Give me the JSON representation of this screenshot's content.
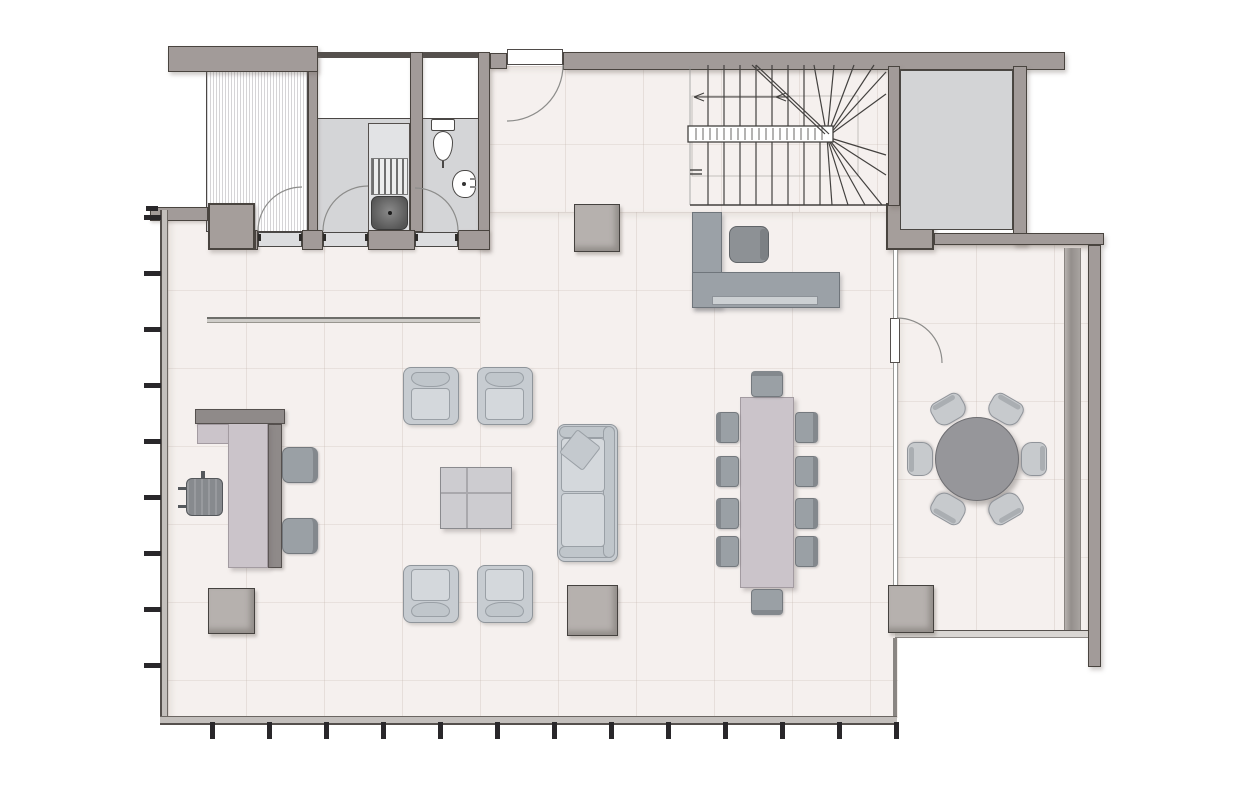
{
  "plan_type": "floor-plan",
  "palette": {
    "background": "#ffffff",
    "wall": "#a29b99",
    "wall_outline": "#49443f",
    "glass_wall": "#c3bfbc",
    "floor": "#f5f0ee",
    "room_gray": "#d4d5d7",
    "shaft_gray": "#d3d4d6",
    "upholstery": "#c7ccd1",
    "upholstery_outline": "#8f959b",
    "table_mauve": "#cbc4ca",
    "chair_gray": "#9aa0a5",
    "desk_gray": "#9ba1a7",
    "planter_gray": "#b6b1ae",
    "round_table_gray": "#96969a",
    "stair_line": "#43413f",
    "mullion_dark": "#29272a",
    "arc_line": "#8c8c8a"
  },
  "rooms": [
    "wardrobe-closet",
    "utility-room",
    "wc",
    "entry-hall",
    "stair",
    "shaft",
    "open-plan-lounge",
    "meeting-room"
  ],
  "inventory": {
    "armchairs": 4,
    "sofa": 1,
    "sofa_pillow": 1,
    "coffee_table": 1,
    "side_tables": 4,
    "dining_table": 1,
    "dining_chairs": 10,
    "round_table": 1,
    "meeting_chairs": 6,
    "office_desk": 1,
    "task_chair": 1,
    "guest_chairs": 2,
    "reception_desk": 1,
    "reception_chair": 1,
    "toilet": 1,
    "washbasin": 1,
    "boiler": 1,
    "drying_rack": 1,
    "swing_doors": 5
  },
  "left_mullions_y": [
    215,
    271,
    327,
    383,
    439,
    495,
    551,
    607,
    663
  ],
  "bottom_mullions_x": [
    210,
    267,
    324,
    381,
    438,
    495,
    552,
    609,
    666,
    723,
    780,
    837,
    894
  ],
  "stairs": {
    "direction": "u-turn-with-winders",
    "upper_treads_x": [
      20,
      36,
      52,
      68,
      84,
      100,
      116
    ],
    "lower_treads_x": [
      20,
      36,
      52,
      68,
      84,
      100,
      116,
      132
    ],
    "upper_fan_ends": [
      [
        126,
        1
      ],
      [
        146,
        1
      ],
      [
        166,
        1
      ],
      [
        186,
        1
      ],
      [
        198,
        8
      ],
      [
        198,
        30
      ]
    ],
    "lower_fan_ends": [
      [
        198,
        91
      ],
      [
        198,
        111
      ],
      [
        194,
        141
      ],
      [
        177,
        141
      ],
      [
        160,
        141
      ],
      [
        144,
        141
      ]
    ],
    "fan_center": [
      139,
      73
    ],
    "baluster_from": 8,
    "baluster_to": 136,
    "baluster_step": 7
  },
  "dining": {
    "side_chair_y": [
      412,
      456,
      498,
      536
    ],
    "left_col_x": 716,
    "right_col_x": 795,
    "end_chair_x": 751,
    "top_chair_y": 371,
    "bottom_chair_y": 589
  },
  "meeting_table": {
    "cx": 977,
    "cy": 459,
    "radius": 42,
    "chair_angles": [
      30,
      90,
      150,
      210,
      270,
      330
    ],
    "chair_offset": 57
  },
  "armchairs": [
    {
      "x": 403,
      "y": 367,
      "face": "down"
    },
    {
      "x": 477,
      "y": 367,
      "face": "down"
    },
    {
      "x": 403,
      "y": 565,
      "face": "up"
    },
    {
      "x": 477,
      "y": 565,
      "face": "up"
    }
  ],
  "door_arcs": [
    "M 563 65 A 56 56 0 0 1 507 121",
    "M 258 231 A 44 44 0 0 1 302 187",
    "M 323 231 A 45 45 0 0 1 368 186",
    "M 458 231 A 43 43 0 0 0 415 188",
    "M 897 318 A 45 45 0 0 1 942 363"
  ]
}
